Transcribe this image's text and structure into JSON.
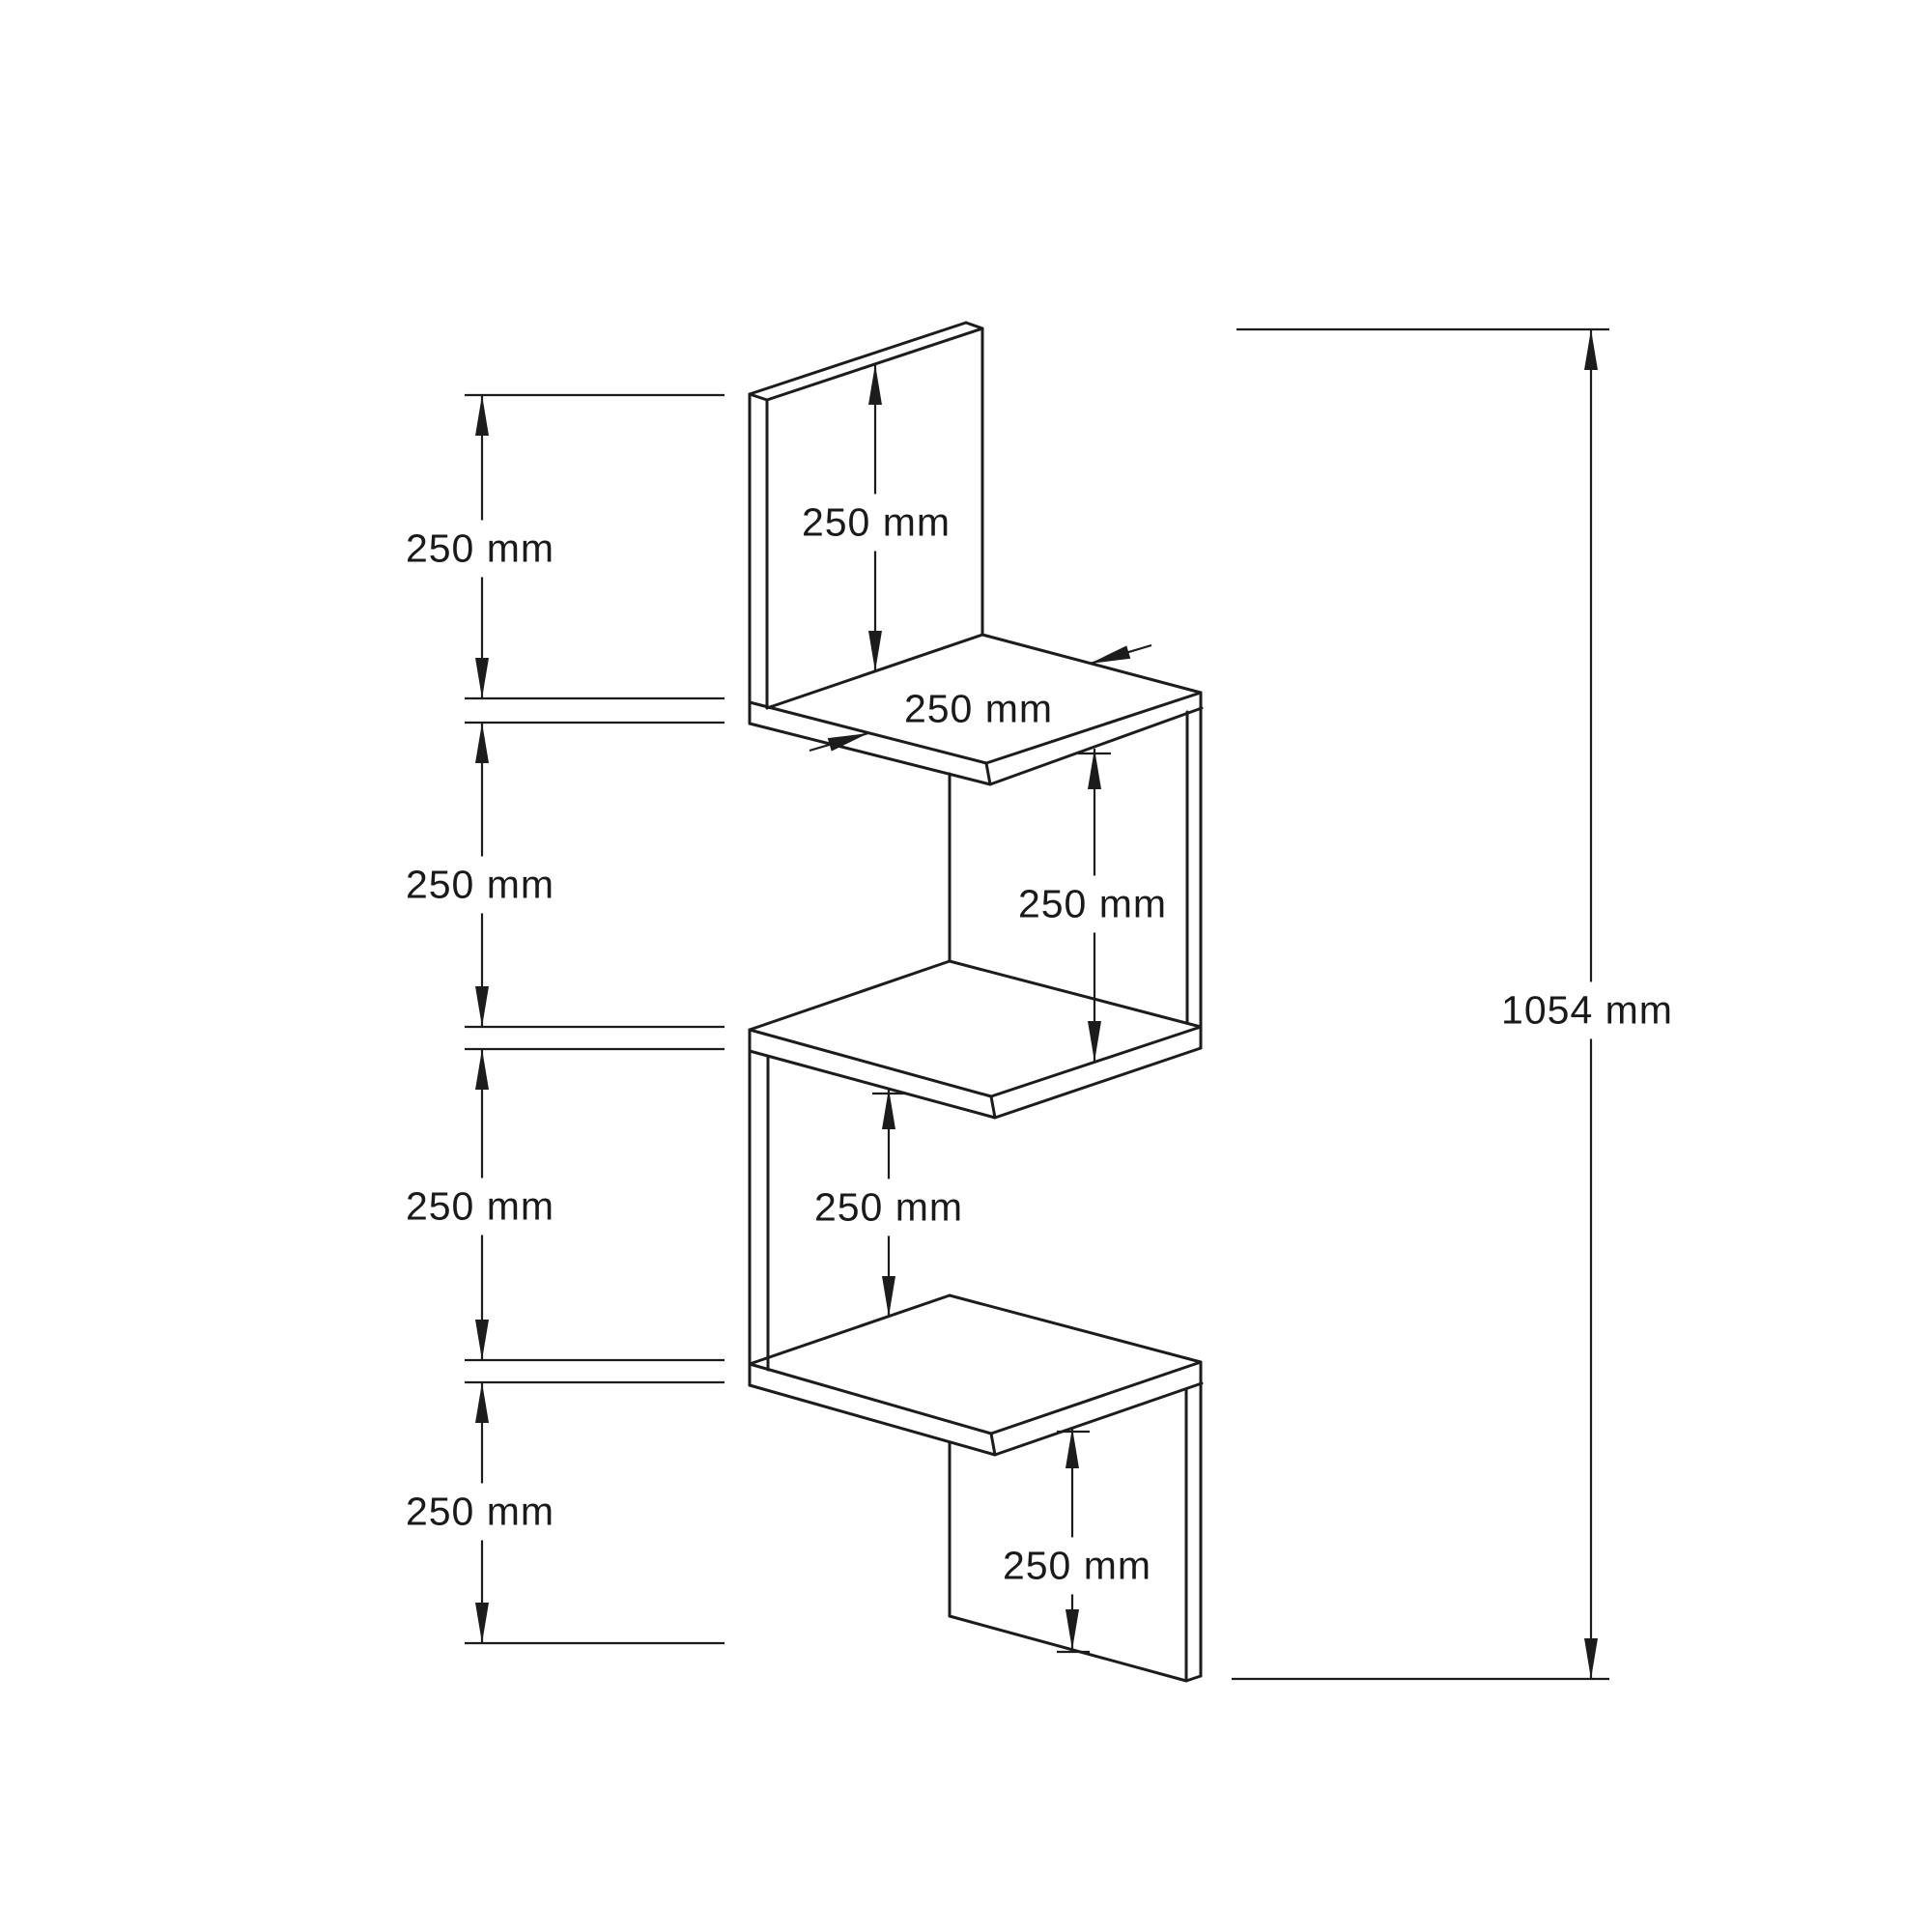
{
  "drawing": {
    "type": "furniture-dimension-diagram",
    "unit": "mm",
    "line_color": "#1c1c1c",
    "background_color": "#ffffff",
    "object": "zigzag corner wall shelf, isometric view, 4 tiers",
    "dims": {
      "segments_left": [
        {
          "label": "250 mm",
          "value_mm": 250
        },
        {
          "label": "250 mm",
          "value_mm": 250
        },
        {
          "label": "250 mm",
          "value_mm": 250
        },
        {
          "label": "250 mm",
          "value_mm": 250
        }
      ],
      "internal": {
        "back_panel_height": {
          "label": "250 mm",
          "value_mm": 250
        },
        "shelf_depth": {
          "label": "250 mm",
          "value_mm": 250
        },
        "gap_upper": {
          "label": "250 mm",
          "value_mm": 250
        },
        "gap_lower": {
          "label": "250 mm",
          "value_mm": 250
        },
        "bottom_panel_height": {
          "label": "250 mm",
          "value_mm": 250
        }
      },
      "total_height": {
        "label": "1054 mm",
        "value_mm": 1054
      }
    }
  }
}
